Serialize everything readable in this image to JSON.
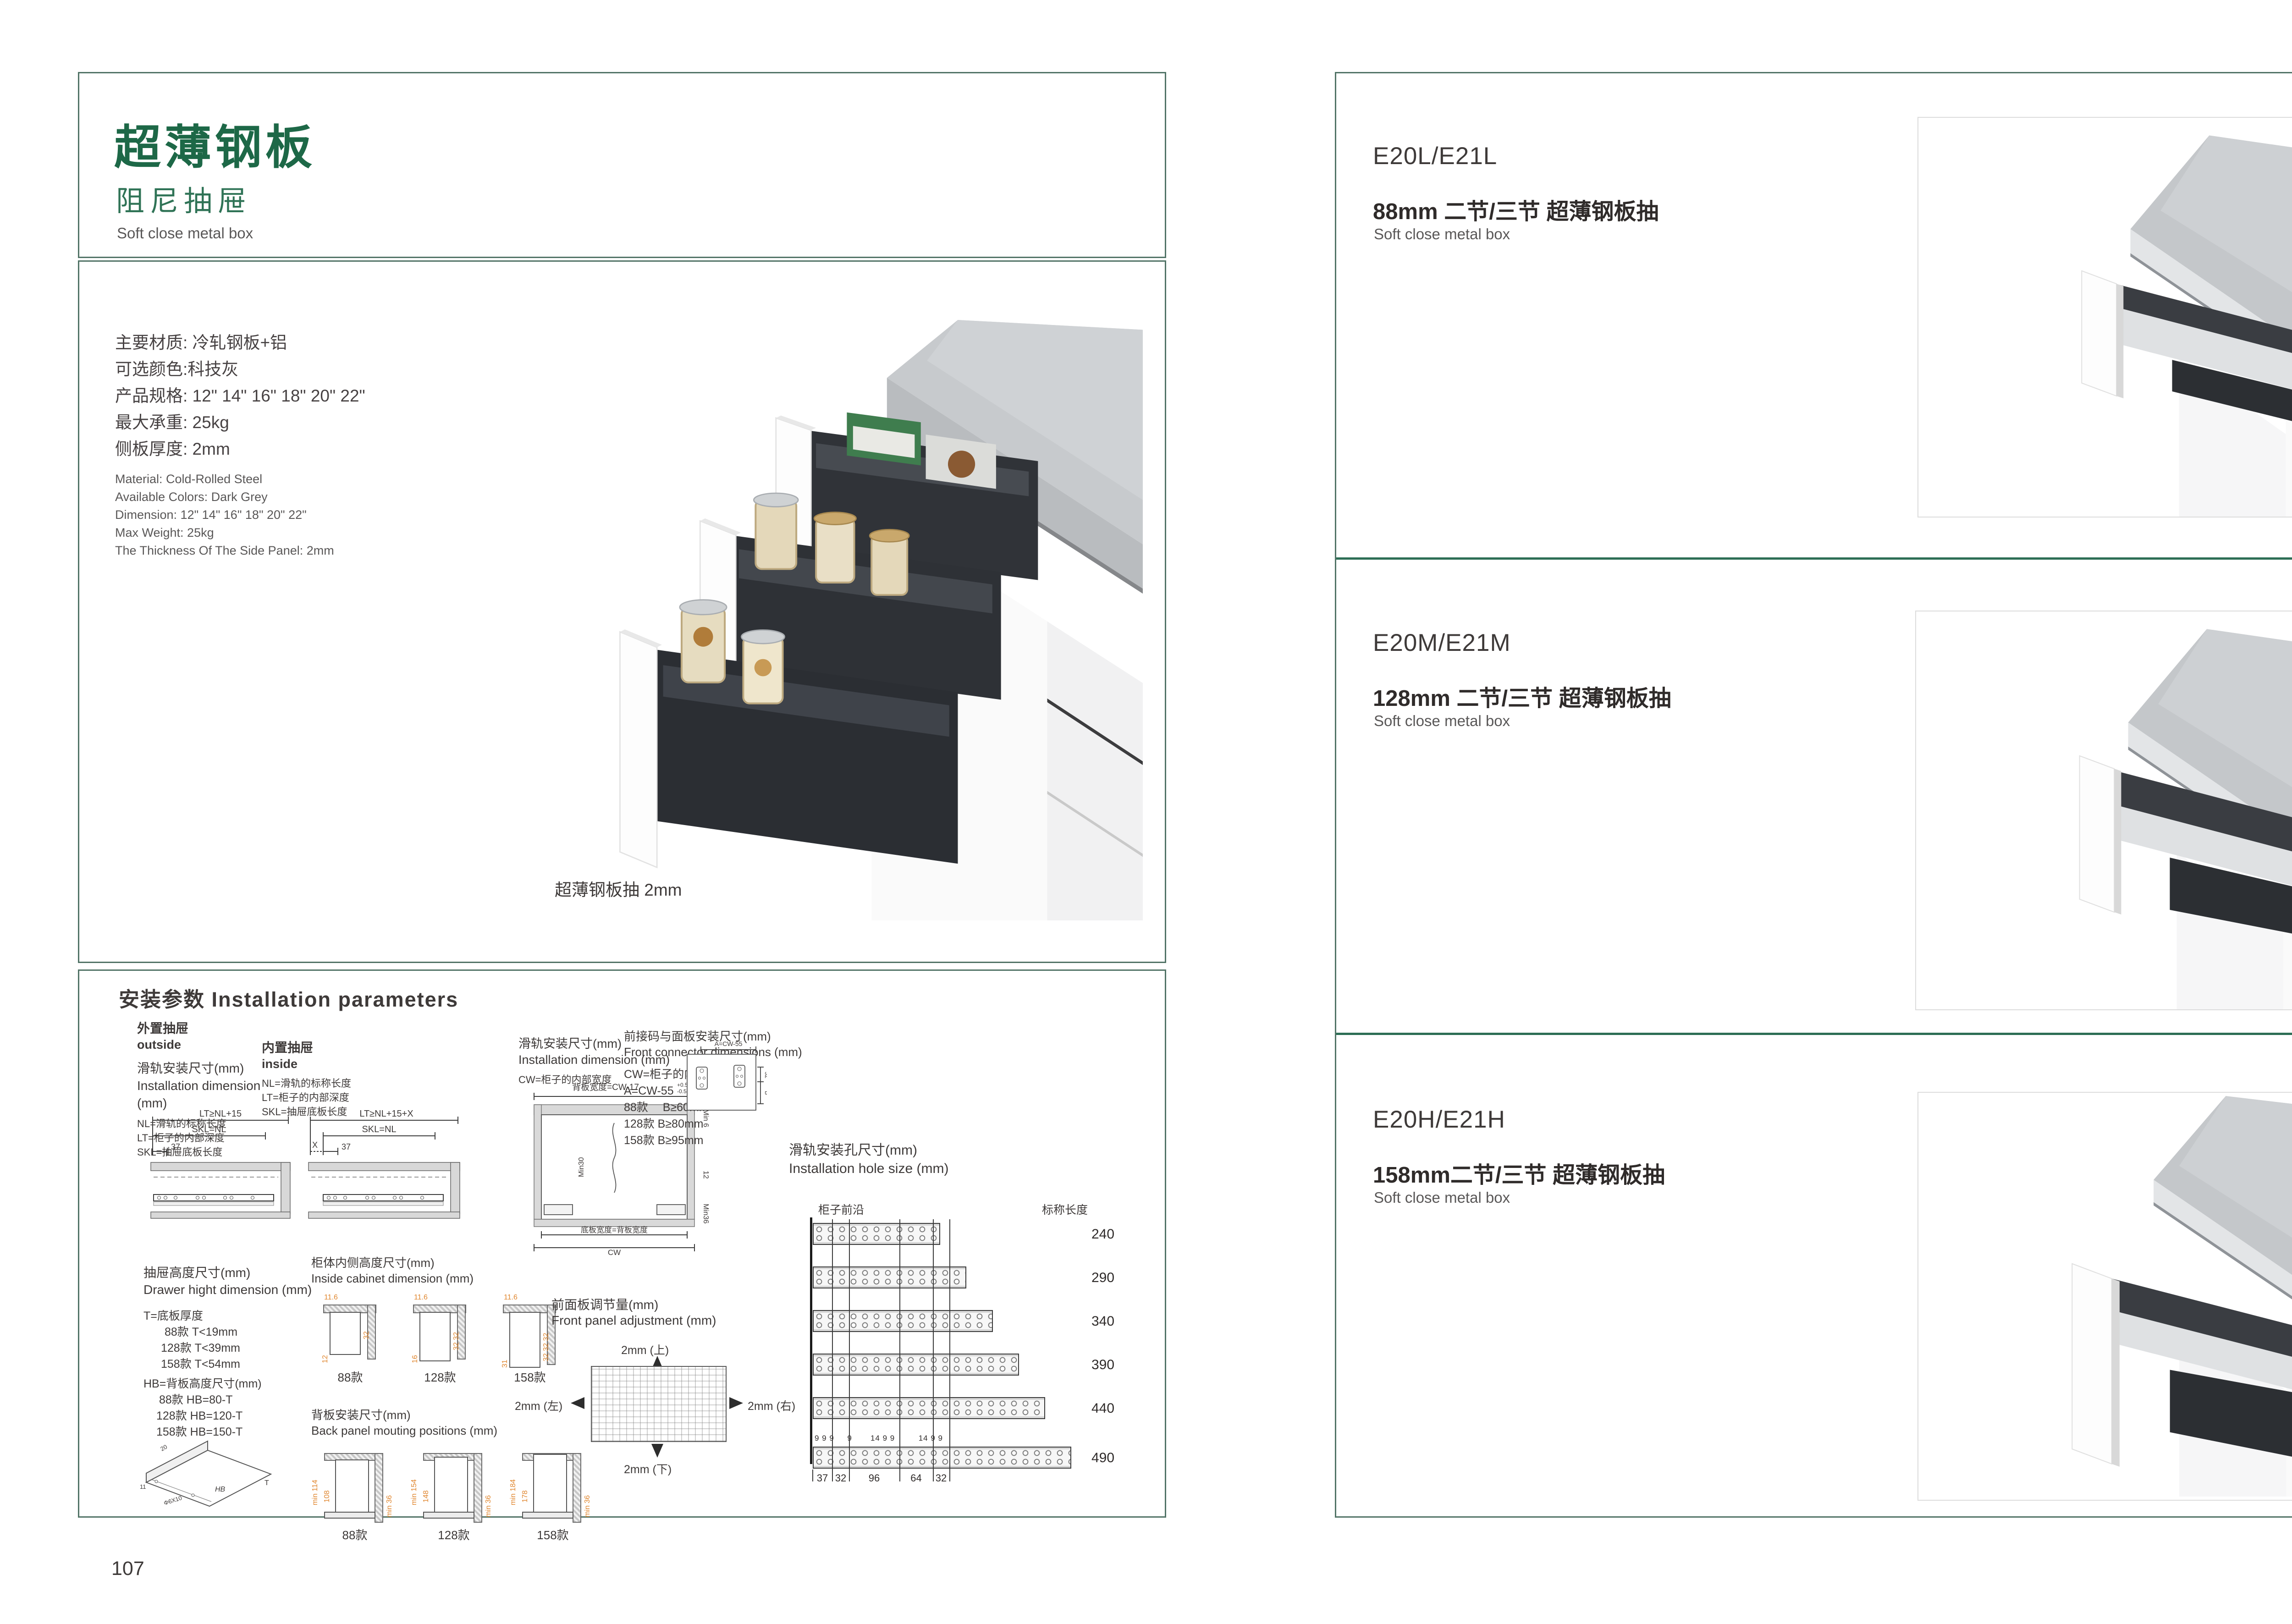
{
  "colors": {
    "accent_green": "#1d6847",
    "sub_green": "#2f7356",
    "box_border": "#527467",
    "divider_green": "#2d6e55",
    "text_dark": "#3e3a39",
    "text_gray": "#595757",
    "dim_orange": "#e0862e"
  },
  "left": {
    "header": {
      "title": "超薄钢板",
      "subtitle": "阻尼抽屉",
      "subtitle_en": "Soft close metal box"
    },
    "specs_cn": [
      "主要材质: 冷轧钢板+铝",
      "可选颜色:科技灰",
      "产品规格: 12\" 14\" 16\" 18\" 20\" 22\"",
      "最大承重: 25kg",
      "侧板厚度: 2mm"
    ],
    "specs_en": [
      "Material: Cold-Rolled Steel",
      "Available Colors: Dark Grey",
      "Dimension: 12\" 14\" 16\" 18\" 20\" 22\"",
      "Max Weight: 25kg",
      "The Thickness Of The Side Panel: 2mm"
    ],
    "product_caption": "超薄钢板抽 2mm",
    "install": {
      "heading": "安装参数 Installation parameters",
      "outside_cn": "外置抽屉",
      "outside_en": "outside",
      "inside_cn": "内置抽屉",
      "inside_en": "inside",
      "raildim_cn": "滑轨安装尺寸(mm)",
      "raildim_en": "Installation dimension (mm)",
      "legend_nl": "NL=滑轨的标称长度",
      "legend_lt": "LT=柜子的内部深度",
      "legend_skl": "SKL=抽屉底板长度",
      "out_lt": "LT≥NL+15",
      "out_skl": "SKL=NL",
      "out_37": "37",
      "in_lt": "LT≥NL+15+X",
      "in_skl": "SKL=NL",
      "in_37": "37",
      "in_x": "X",
      "cw_legend": "CW=柜子的内部宽度",
      "back_width": "背板宽度=CW-17",
      "tol_up": "+0.5",
      "tol_dn": "-0.5",
      "min6": "Min 6",
      "min30": "Min30",
      "d12": "12",
      "min36": "Min36",
      "bottom_width": "底板宽度=背板宽度",
      "cw": "CW",
      "conn_cn": "前接码与面板安装尺寸(mm)",
      "conn_en": "Front connector  dimensions (mm)",
      "conn_cw": "CW=柜子的内部宽度",
      "conn_a": "A=CW-55",
      "conn_rows": [
        "88款　 B≥60mm",
        "128款  B≥80mm",
        "158款  B≥95mm"
      ],
      "conn_dim_a": "A=CW-55",
      "conn_dim_32": "32",
      "conn_dim_b": "B",
      "hole_cn": "滑轨安装孔尺寸(mm)",
      "hole_en": "Installation hole size (mm)",
      "cab_front": "柜子前沿",
      "nominal": "标称长度",
      "rail_lengths": [
        "240",
        "290",
        "340",
        "390",
        "440",
        "490"
      ],
      "rail_gaps": "9 9 9     9       14 9 9         14 9 9",
      "hole_dims": [
        "37",
        "32",
        "96",
        "64",
        "32"
      ],
      "dh_cn": "抽屉高度尺寸(mm)",
      "dh_en": "Drawer hight dimension (mm)",
      "t_legend": "T=底板厚度",
      "t_rows": [
        "88款   T<19mm",
        "128款  T<39mm",
        "158款  T<54mm"
      ],
      "hb_legend": "HB=背板高度尺寸(mm)",
      "hb_rows": [
        "88款   HB=80-T",
        "128款 HB=120-T",
        "158款 HB=150-T"
      ],
      "iso": {
        "d20": "20",
        "d11": "11",
        "screw": "Φ6X10",
        "hb": "HB",
        "t": "T"
      },
      "ic_cn": "柜体内侧高度尺寸(mm)",
      "ic_en": "Inside cabinet dimension (mm)",
      "ic_items": [
        {
          "label": "88款",
          "top": "11.6",
          "v1": "32",
          "v2": "12"
        },
        {
          "label": "128款",
          "top": "11.6",
          "v1": "32 32",
          "v2": "16"
        },
        {
          "label": "158款",
          "top": "11.6",
          "v1": "32 32 32",
          "v2": "31"
        }
      ],
      "bp_cn": "背板安装尺寸(mm)",
      "bp_en": "Back panel mouting positions (mm)",
      "bp_items": [
        {
          "label": "88款",
          "minh": "min 114",
          "h": "108",
          "minb": "min 36"
        },
        {
          "label": "128款",
          "minh": "min 154",
          "h": "148",
          "minb": "min 36"
        },
        {
          "label": "158款",
          "minh": "min 184",
          "h": "178",
          "minb": "min 36"
        }
      ],
      "fa_cn": "前面板调节量(mm)",
      "fa_en": "Front panel adjustment (mm)",
      "fa_up": "2mm (上)",
      "fa_down": "2mm (下)",
      "fa_left": "2mm (左)",
      "fa_right": "2mm (右)"
    },
    "page_number": "107"
  },
  "right": {
    "sections": [
      {
        "model": "E20L/E21L",
        "title_cn": "88mm 二节/三节 超薄钢板抽",
        "title_en": "Soft close metal box"
      },
      {
        "model": "E20M/E21M",
        "title_cn": "128mm 二节/三节 超薄钢板抽",
        "title_en": "Soft close metal box"
      },
      {
        "model": "E20H/E21H",
        "title_cn": "158mm二节/三节 超薄钢板抽",
        "title_en": "Soft close metal box"
      }
    ],
    "page_number": "108"
  }
}
